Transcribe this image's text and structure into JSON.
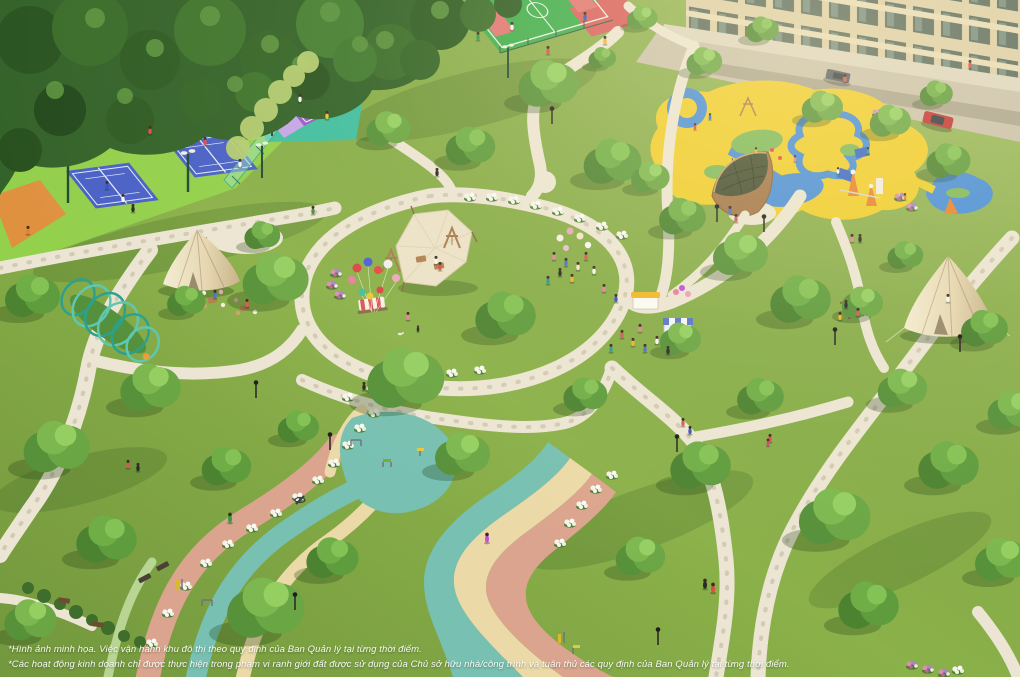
{
  "disclaimer": {
    "line1": "*Hình ảnh minh họa. Việc vận hành khu đô thị theo quy định của Ban Quản lý tại từng thời điểm.",
    "line2": "*Các hoạt động kinh doanh chỉ được thực hiện trong phạm vi ranh giới đất được sử dụng của Chủ sở hữu nhà/công trình và tuân thủ các quy định của Ban Quản lý tại từng thời điểm."
  },
  "scene": {
    "type": "aerial-3d-render-of-residential-park",
    "elements": [
      "forest-canopy",
      "tennis-courts",
      "orange-court",
      "padel-court",
      "basketball-court",
      "children-playground",
      "dome-pavilion",
      "residential-building",
      "access-road",
      "parked-cars",
      "walking-path-network",
      "rainbow-jogging-track",
      "outdoor-gym",
      "bell-tents",
      "event-canopy",
      "swing-frames",
      "balloon-clusters",
      "food-kiosks",
      "picnic-areas",
      "caterpillar-tunnel",
      "flower-hedges",
      "lawns",
      "trees",
      "lamp-posts",
      "park-visitors"
    ]
  },
  "palette": {
    "lawn": "#8bb14a",
    "path": "#ece5d3",
    "court_apron": "#93d04c",
    "court_blue": "#4a61c6",
    "court_orange": "#df9140",
    "padel_teal": "#41bfa0",
    "padel_purple": "#9a58c9",
    "padel_lavender": "#c5a6e8",
    "basketball_green": "#3fae4e",
    "basketball_pink": "#e07575",
    "basketball_red": "#d95f5f",
    "playground_yellow": "#f0cd2e",
    "playground_blue": "#4a8fd9",
    "track_pink": "#dba48e",
    "track_teal": "#77c0b2",
    "track_cream": "#ecd9a8",
    "track_green": "#b9d593",
    "building": "#decfa9",
    "road": "#cbc2ae",
    "car_red": "#c23232",
    "text_white": "#ffffff"
  }
}
